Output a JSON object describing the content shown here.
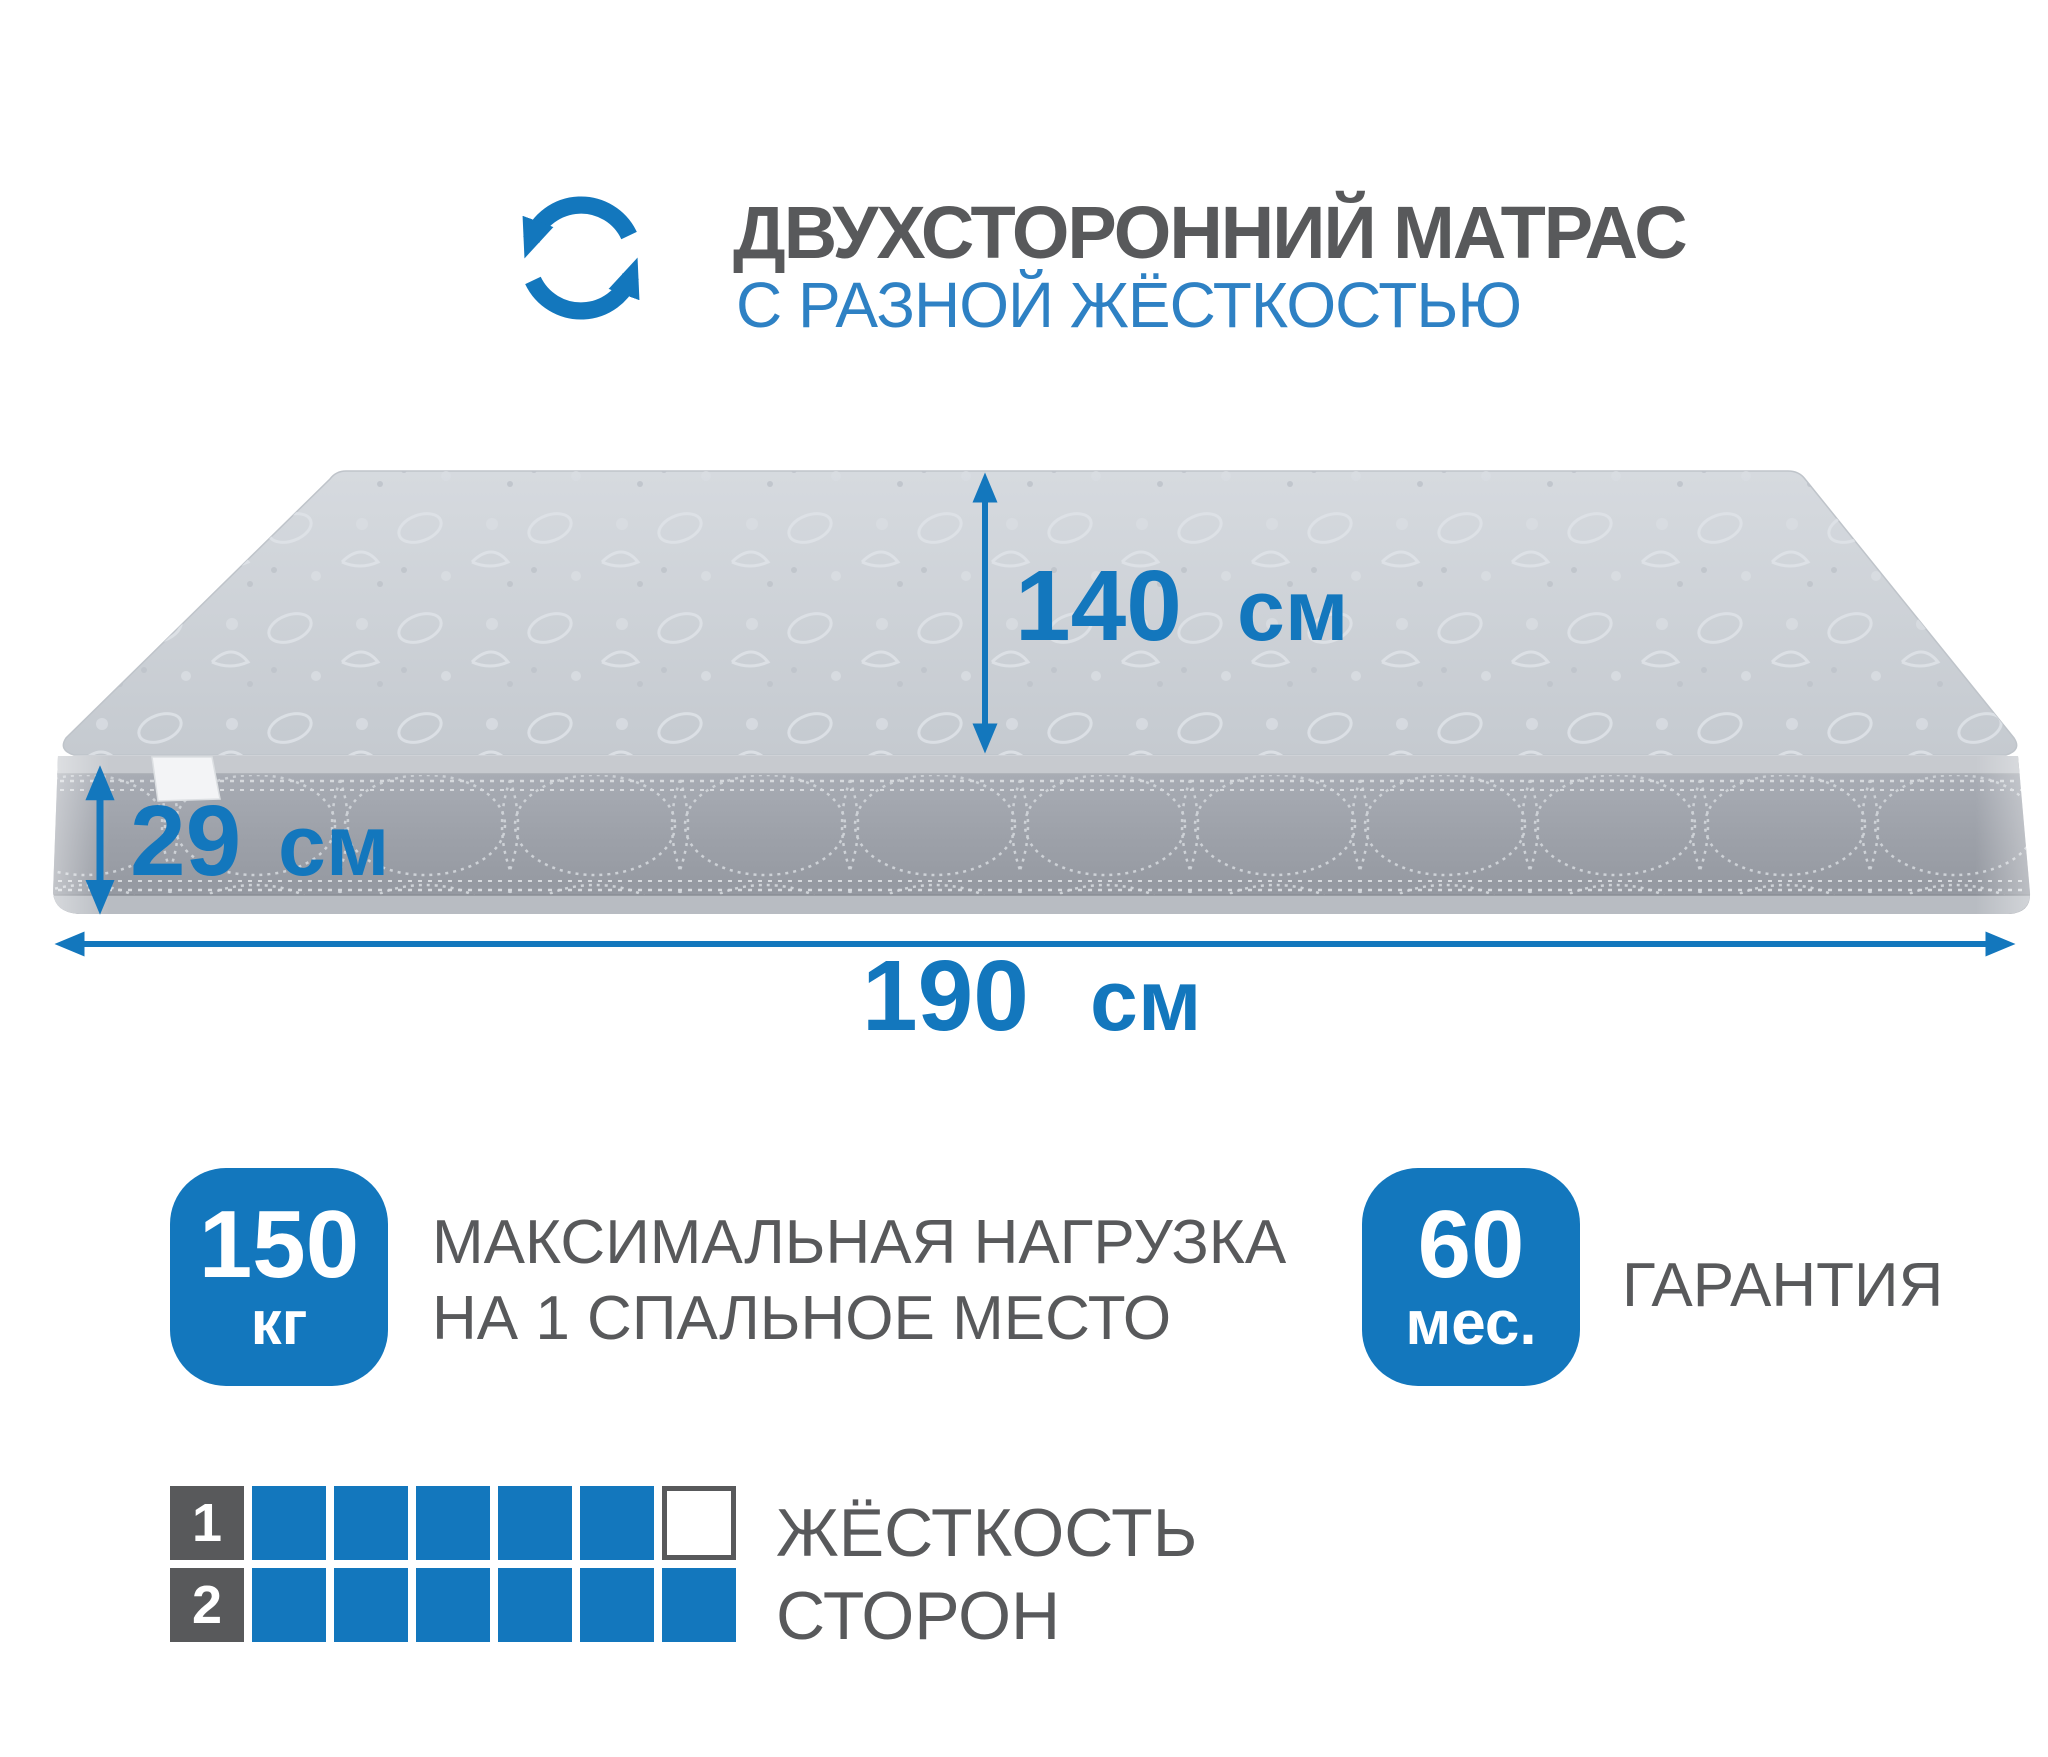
{
  "header": {
    "title": "ДВУХСТОРОННИЙ МАТРАС",
    "subtitle": "С РАЗНОЙ ЖЁСТКОСТЬЮ",
    "icon": "rotate-arrows"
  },
  "dimensions": {
    "length_top": {
      "value": "140",
      "unit": "см"
    },
    "height_side": {
      "value": "29",
      "unit": "см"
    },
    "width_front": {
      "value": "190",
      "unit": "см"
    }
  },
  "features": {
    "max_load": {
      "value": "150",
      "unit": "кг",
      "line1": "МАКСИМАЛЬНАЯ НАГРУЗКА",
      "line2": "НА 1 СПАЛЬНОЕ МЕСТО"
    },
    "warranty": {
      "value": "60",
      "unit": "мес.",
      "label": "ГАРАНТИЯ"
    }
  },
  "firmness": {
    "line1": "ЖЁСТКОСТЬ",
    "line2": "СТОРОН",
    "scale_max": 6,
    "rows": [
      {
        "side": "1",
        "filled": 5
      },
      {
        "side": "2",
        "filled": 6
      }
    ]
  },
  "colors": {
    "brand_blue": "#1377BD",
    "subtitle_blue": "#2E81C4",
    "text_gray": "#58595B"
  }
}
